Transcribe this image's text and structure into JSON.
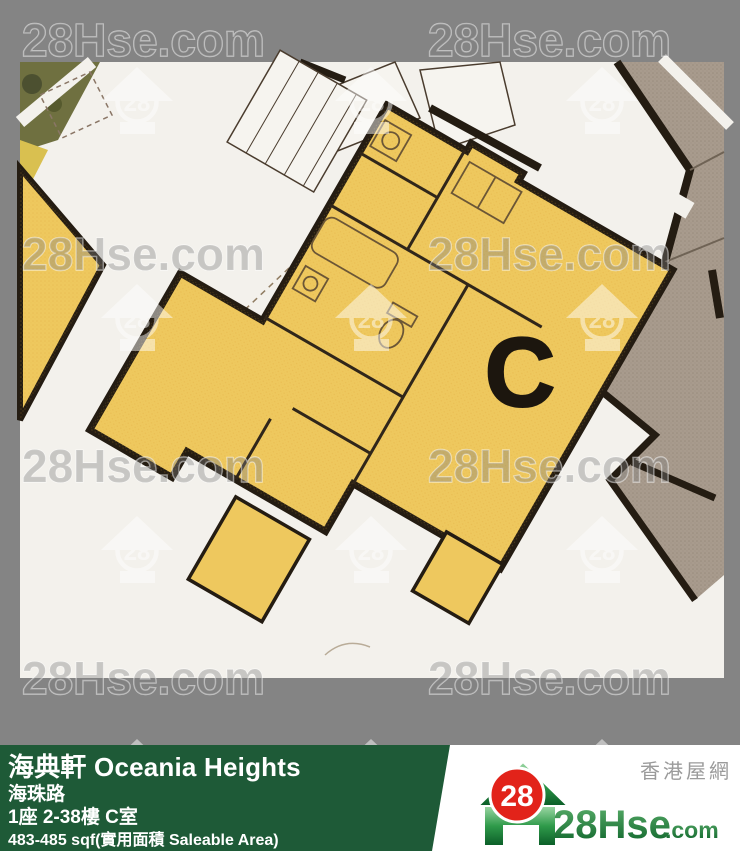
{
  "watermark": {
    "text": "28Hse.com",
    "badge": "28"
  },
  "plan": {
    "unit_label": "C",
    "colors": {
      "highlight_unit_yellow": "#eec85e",
      "adjacent_unit_taupe": "#a89b8d",
      "wall_black": "#241c12",
      "paper": "#f3f1ec",
      "frame_gray": "#848484"
    }
  },
  "footer": {
    "title": "海典軒 Oceania Heights",
    "road": "海珠路",
    "block_floor_unit": "1座 2-38樓 C室",
    "area": "483-485 sqf(實用面積 Saleable Area)",
    "bar_green": "#1e5a37"
  },
  "logo": {
    "site_name_zh": "香港屋網",
    "badge": "28",
    "brand": "28Hse",
    "brand_suffix": ".com",
    "brand_green": "#0b6128",
    "badge_red": "#e2231a"
  }
}
